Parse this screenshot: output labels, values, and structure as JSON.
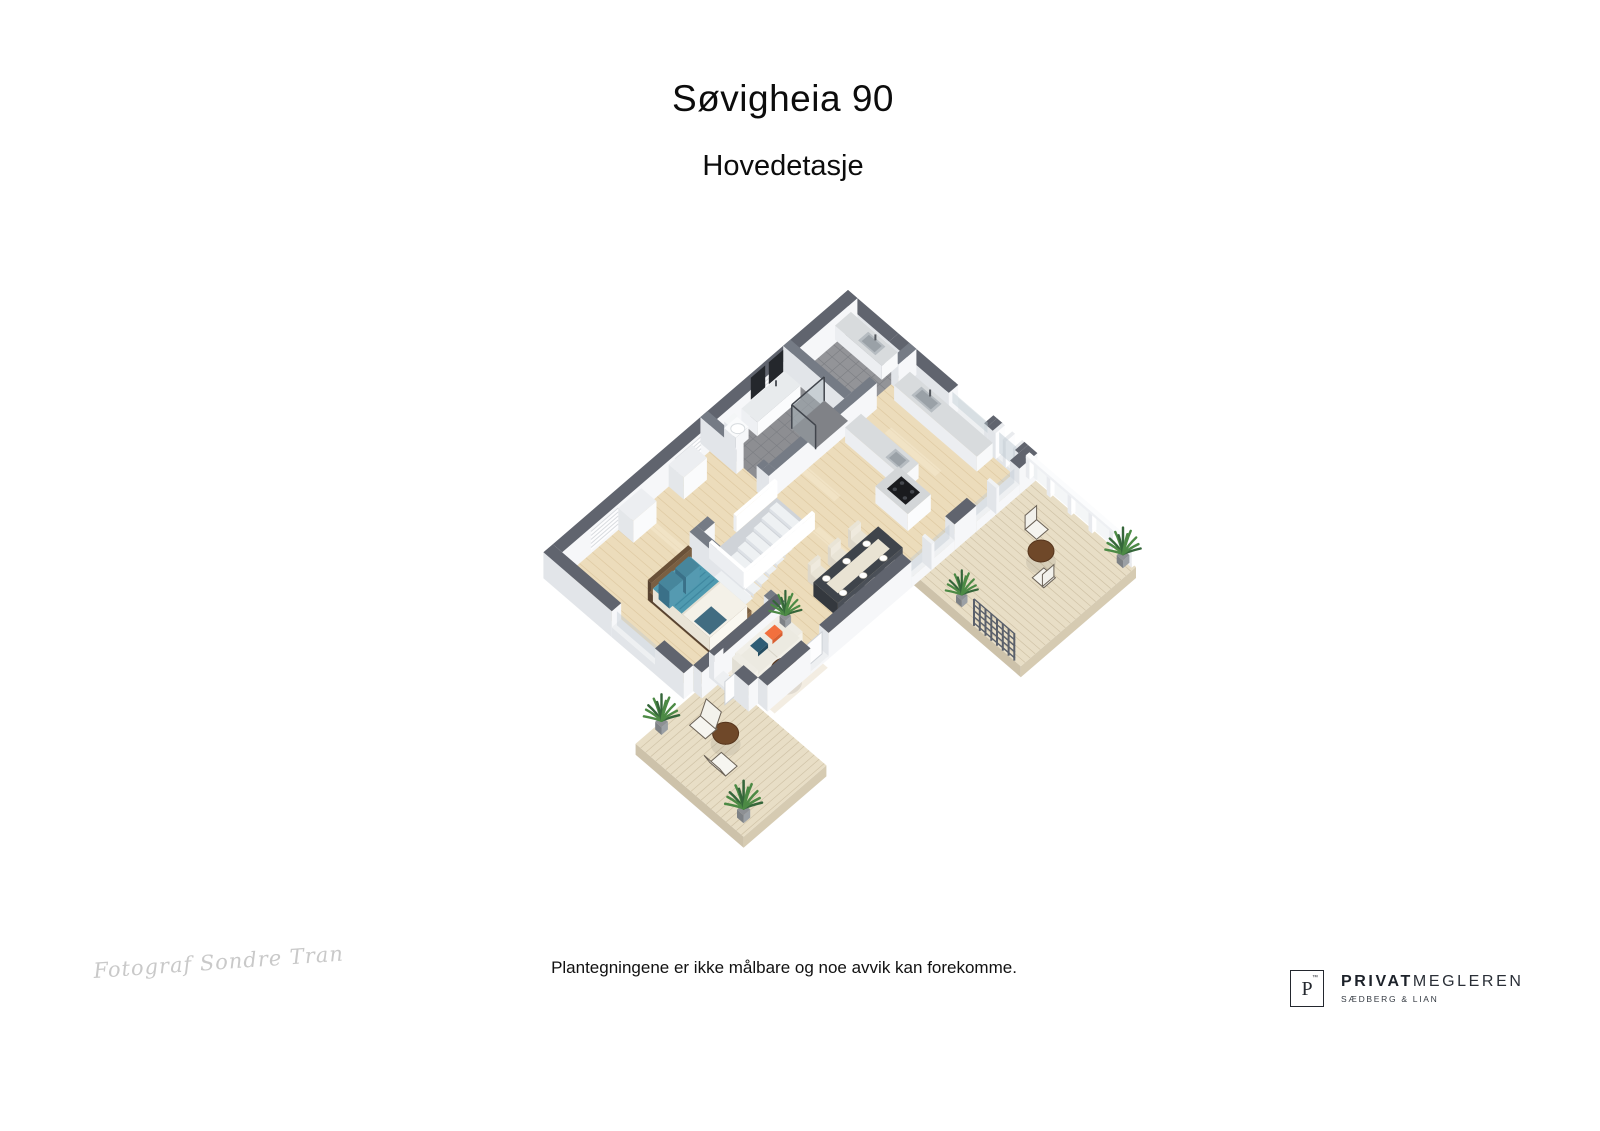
{
  "page": {
    "title": "Søvigheia 90",
    "subtitle": "Hovedetasje"
  },
  "footer": {
    "photographer_signature": "Fotograf Sondre Transeth",
    "disclaimer": "Plantegningene er ikke målbare og noe avvik kan forekomme."
  },
  "brand": {
    "symbol": "P",
    "mark": "™",
    "name_bold": "PRIVAT",
    "name_light": "MEGLEREN",
    "subname": "SÆDBERG & LIAN"
  },
  "floor_plan": {
    "type": "3d-isometric-floorplan",
    "rooms": [
      "hallway",
      "bathroom",
      "laundry-room",
      "kitchen",
      "living-dining-room",
      "bedroom",
      "terrace-east",
      "terrace-south"
    ],
    "furniture": [
      "double-bed",
      "sofa",
      "coffee-table",
      "rug",
      "dining-table-6-chairs",
      "kitchen-island-cooktop",
      "kitchen-counter-sink",
      "laundry-counter-sink",
      "vanity-mirrors",
      "toilet",
      "shower",
      "staircase-railing",
      "outdoor-table-chairs",
      "sun-loungers",
      "potted-plants",
      "trellis-gate"
    ],
    "palette": {
      "background": "#ffffff",
      "floor_wood": "#ecdcbb",
      "floor_wood_streak": "#dcc69e",
      "floor_wood_light": "#f6ead0",
      "terrace_wood": "#e8decachanged",
      "terrace_top": "#e8dec6",
      "terrace_plank": "#d0c3a7",
      "terrace_edge": "#d6cbb2",
      "tile_floor": "#8d8e92",
      "tile_floor2": "#939498",
      "tile_line": "#7c7e83",
      "wall_cap_ext": "#60646e",
      "wall_cap_int": "#757b85",
      "wall_face_light": "#f6f7f9",
      "wall_face_shade": "#e2e5e9",
      "glass": "#bdc9d1",
      "bed_teal": "#4f9ab0",
      "bed_teal_dark": "#3f87a0",
      "bed_linen": "#f4f1e8",
      "bed_frame": "#6a5138",
      "pillow_orange": "#f2703d",
      "pillow_navy": "#2e5d75",
      "sofa": "#eceae1",
      "rug": "#f2ecdf",
      "table_wood": "#6f4829",
      "dining_top": "#3f444b",
      "dining_runner": "#e9e3d3",
      "chair": "#e9e4d6",
      "island_top": "#d3d6d8",
      "counter_top": "#d8dbdd",
      "cooktop": "#1a1b1e",
      "sink": "#b6bcc1",
      "plant_green": "#4c8a45",
      "plant_dark": "#35663a",
      "pot": "#8d9094",
      "trellis": "#5a606b",
      "white": "#ffffff",
      "signature_gray": "#c9c9c9",
      "text_dark": "#0c0c0c"
    }
  }
}
